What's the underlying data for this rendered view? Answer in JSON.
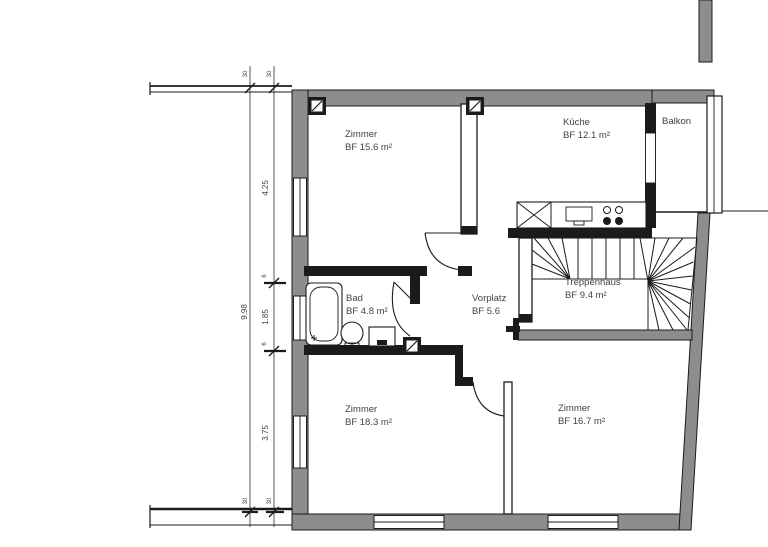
{
  "plan": {
    "type": "floor-plan",
    "rooms": {
      "zimmer_top": {
        "name": "Zimmer",
        "area": "BF 15.6 m²"
      },
      "kueche": {
        "name": "Küche",
        "area": "BF 12.1 m²"
      },
      "balkon": {
        "name": "Balkon",
        "area": ""
      },
      "treppenhaus": {
        "name": "Treppenhaus",
        "area": "BF 9.4 m²"
      },
      "bad": {
        "name": "Bad",
        "area": "BF 4.8 m²"
      },
      "vorplatz": {
        "name": "Vorplatz",
        "area": "BF 5.6"
      },
      "zimmer_bottom_left": {
        "name": "Zimmer",
        "area": "BF 18.3 m²"
      },
      "zimmer_bottom_right": {
        "name": "Zimmer",
        "area": "BF 16.7 m²"
      }
    },
    "dimensions": {
      "total_height": "9.98",
      "segment_top": "4.25",
      "segment_middle": "1.85",
      "segment_bottom": "3.75",
      "wall_small_1": "6",
      "wall_small_2": "6",
      "wall_top_left": "30",
      "wall_top_right": "30",
      "wall_bottom_left": "30",
      "wall_bottom_right": "30"
    },
    "colors": {
      "wall_fill": "#8d8d8d",
      "line": "#1b1b1b",
      "text": "#3a4453"
    }
  }
}
